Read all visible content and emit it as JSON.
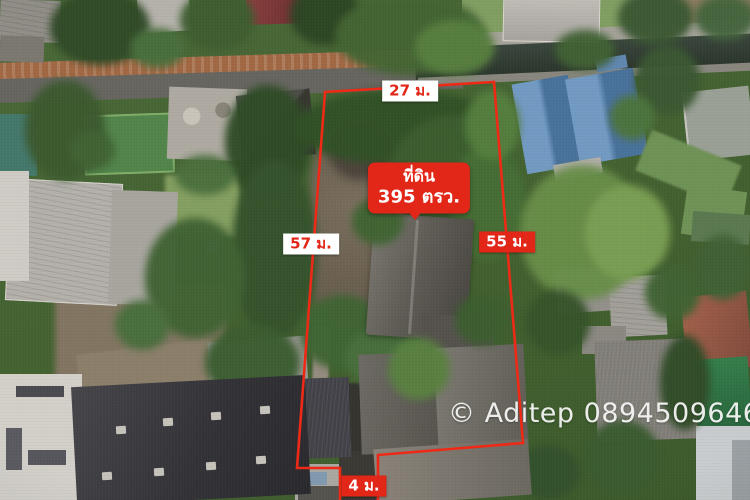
{
  "overlay": {
    "dimensions": {
      "top": "27 ม.",
      "left": "57 ม.",
      "right": "55 ม.",
      "access": "4 ม."
    },
    "plot_label": {
      "line1": "ที่ดิน",
      "line2": "395 ตรว."
    },
    "watermark": "© Aditep 0894509646",
    "colors": {
      "boundary_red": "#ee2a17",
      "label_red_bg": "#e22617",
      "label_white_bg": "#ffffff",
      "watermark_text": "#f6f6f4"
    }
  }
}
